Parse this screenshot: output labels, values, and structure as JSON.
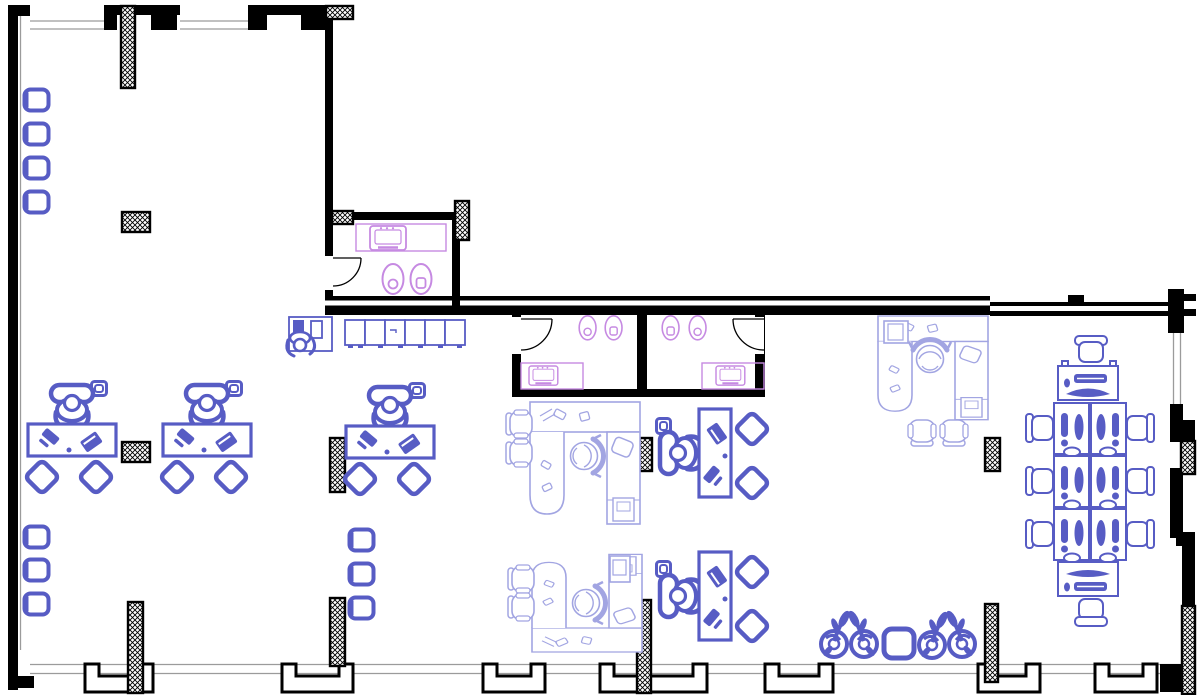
{
  "title": "office-floor-plan-drawing",
  "colors": {
    "background": "#ffffff",
    "wall": "#000000",
    "window": "#9b9b9b",
    "furniture": "#575cc4",
    "exec": "#a2a5e2",
    "fixture": "#c68ae2"
  },
  "inventory": {
    "workstations_with_occupant": 5,
    "guest_diamond_chairs": 10,
    "executive_u_desks": 3,
    "executive_guest_chairs": 6,
    "bench_desks": 8,
    "bench_chairs": 8,
    "wall_seats": 10,
    "storage_cabinets": 6,
    "reception_desks": 1,
    "restrooms": 3,
    "toilets": 6,
    "sinks": 3,
    "doors": 3,
    "structural_columns": 15,
    "lounge_plants": 4,
    "lounge_tables": 1,
    "desk_plants": 5
  }
}
